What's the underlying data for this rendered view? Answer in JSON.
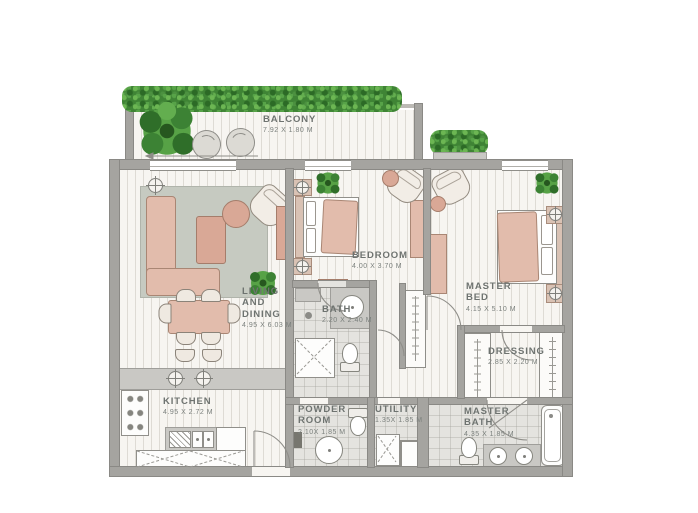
{
  "plan_type": "apartment-floor-plan",
  "rooms": [
    {
      "id": "balcony",
      "name": "BALCONY",
      "dims": "7.92 X 1.80 M"
    },
    {
      "id": "living",
      "name": "LIVING\nAND\nDINING",
      "dims": "4.95 X 6.03 M"
    },
    {
      "id": "bedroom",
      "name": "BEDROOM",
      "dims": "4.00 X 3.70 M"
    },
    {
      "id": "bath",
      "name": "BATH",
      "dims": "2.20 X 2.40 M"
    },
    {
      "id": "master-bed",
      "name": "MASTER\nBED",
      "dims": "4.15 X 5.10 M"
    },
    {
      "id": "dressing",
      "name": "DRESSING",
      "dims": "2.85 X 2.20 M"
    },
    {
      "id": "kitchen",
      "name": "KITCHEN",
      "dims": "4.95 X 2.72 M"
    },
    {
      "id": "powder-room",
      "name": "POWDER\nROOM",
      "dims": "2.10X 1.85 M"
    },
    {
      "id": "utility",
      "name": "UTILITY",
      "dims": "1.35X 1.85 M"
    },
    {
      "id": "master-bath",
      "name": "MASTER\nBATH",
      "dims": "4.35 X 1.85 M"
    }
  ],
  "colors": {
    "wall": "#a5a4a0",
    "floor": "#f7f5f1",
    "tile": "#e4e3df",
    "furniture_pink": "#e2bcac",
    "rug": "#c6cac1",
    "plant_green": "#4c9140",
    "label_text": "#6e7370"
  },
  "icons": [
    "plant-icon",
    "hedge-icon",
    "ceiling-lamp-icon",
    "door-swing-arc-icon",
    "shower-icon",
    "washer-icon",
    "bathtub-icon",
    "toilet-icon",
    "sink-icon",
    "wardrobe-icon",
    "sofa-icon",
    "bed-icon",
    "dining-table-icon",
    "armchair-icon",
    "stove-icon",
    "balcony-chair-icon"
  ]
}
